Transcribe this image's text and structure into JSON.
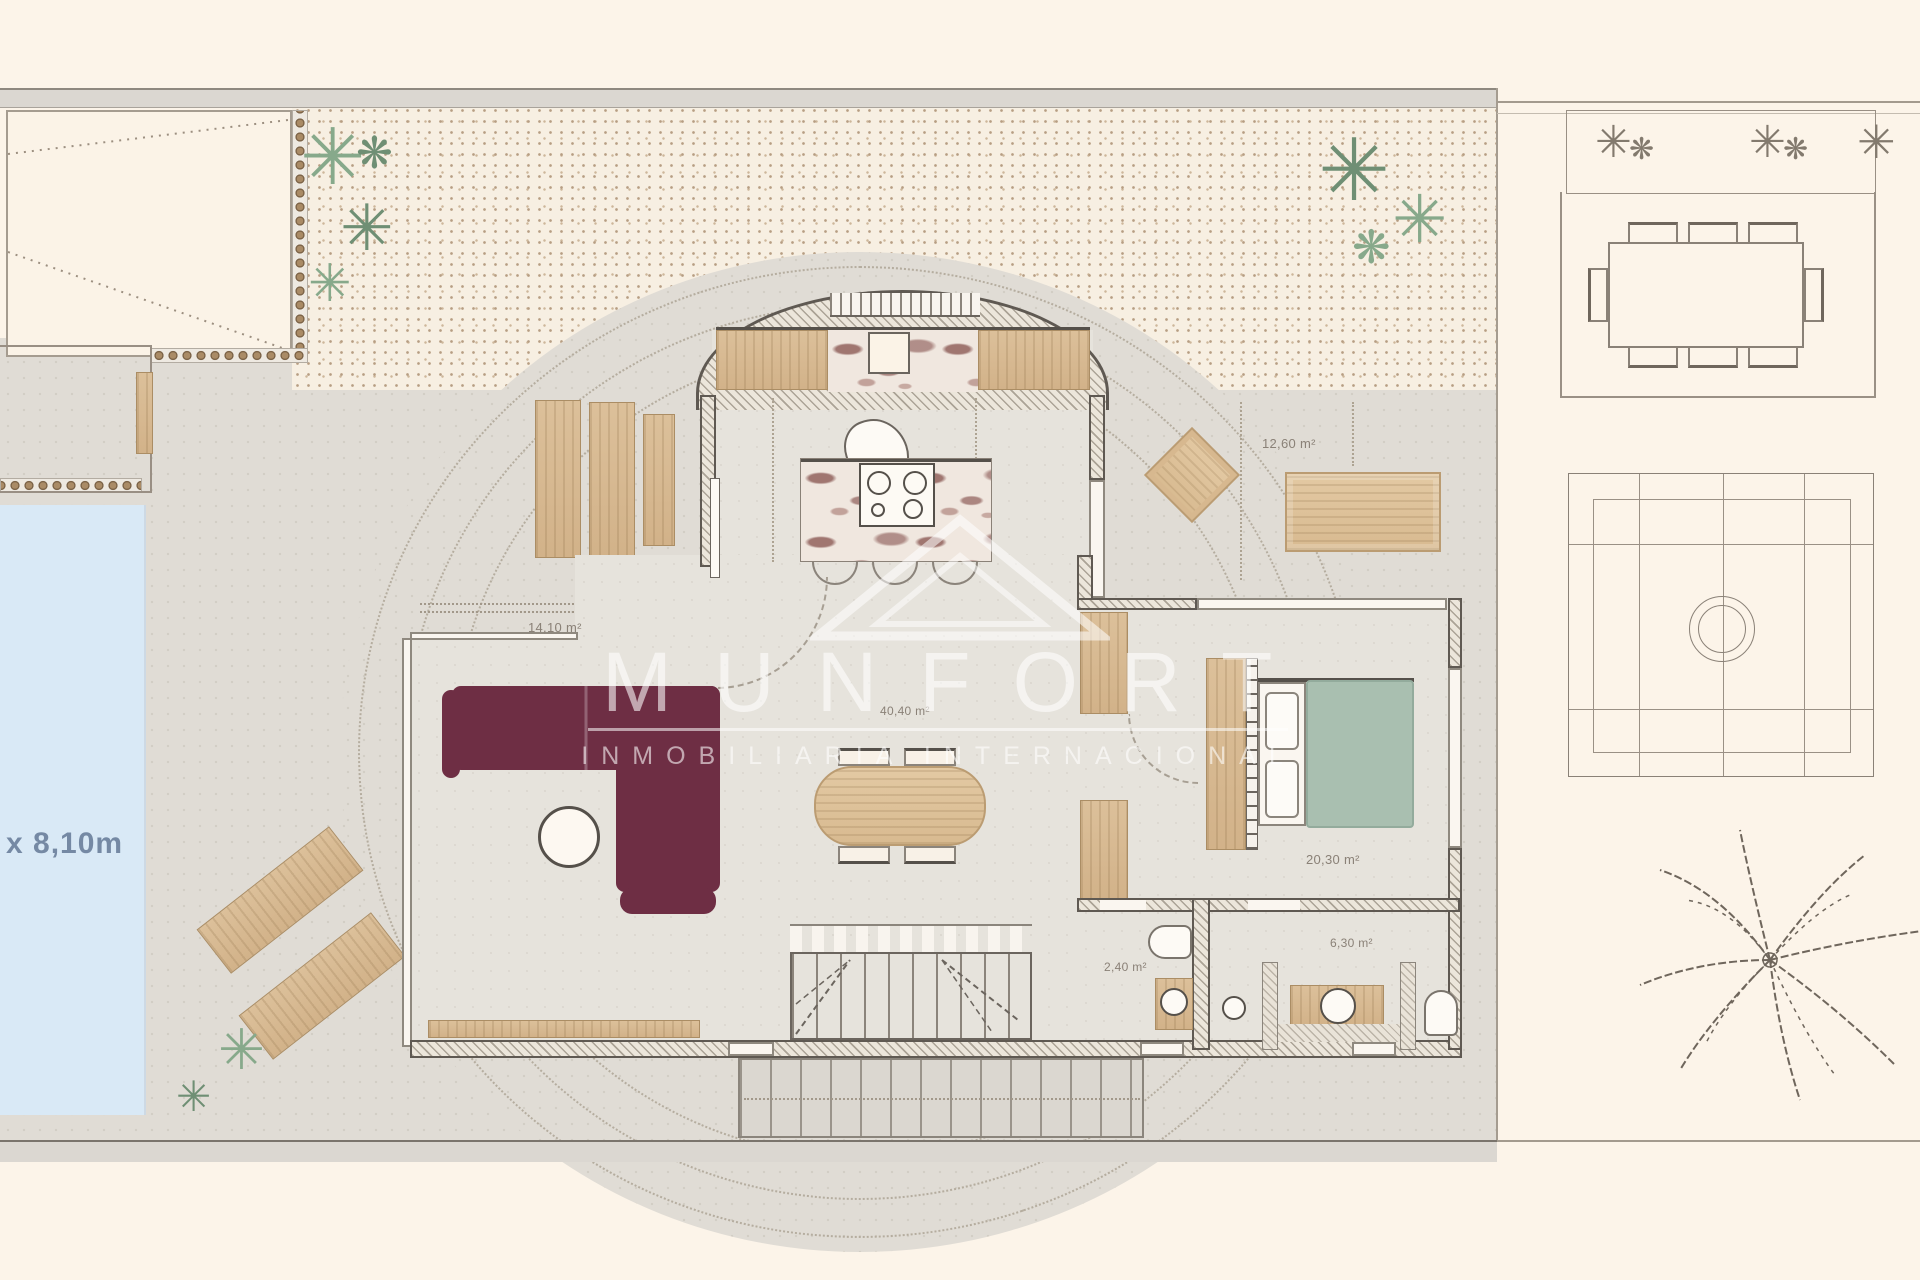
{
  "watermark": {
    "brand": "MUNFORT",
    "subtitle": "INMOBILIARIA INTERNACIONAL"
  },
  "pool": {
    "size_label": "x 8,10m"
  },
  "room_areas": {
    "covered_terrace": "14,10 m²",
    "living_kitchen": "40,40 m²",
    "side_terrace": "12,60 m²",
    "bedroom": "20,30 m²",
    "wc": "2,40 m²",
    "bathroom": "6,30 m²"
  },
  "colors": {
    "background_cream": "#fcf4e9",
    "terrace_gray": "#e0dcd5",
    "gravel": "#f7efe2",
    "pool_blue": "#d9e9f6",
    "pool_text": "#7589a4",
    "sofa_burgundy": "#6e2e44",
    "bed_green": "#a9bfb0",
    "wood": "#d9bd97",
    "wall_dark": "#55504a",
    "watermark_white": "rgba(255,255,255,0.58)"
  }
}
